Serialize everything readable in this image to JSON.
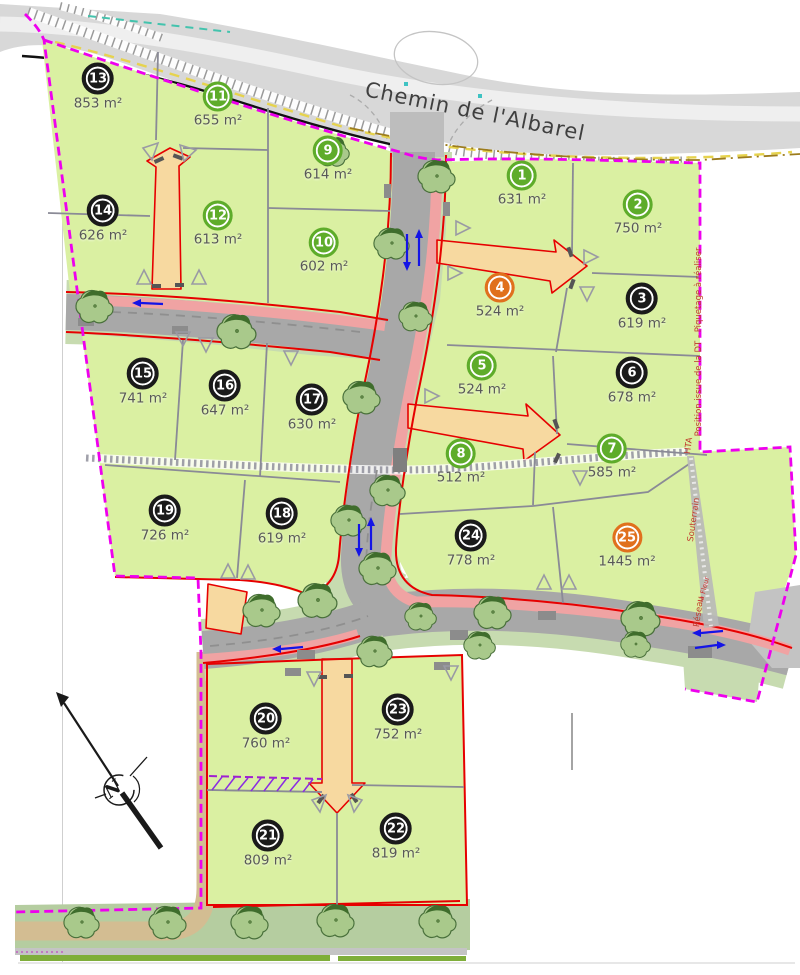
{
  "map": {
    "street_label": "Chemin de l'Albarel",
    "north_letter": "N",
    "area_unit": "m²"
  },
  "annotations": {
    "dt_note": "Position issue de la DT - Piquetage à réaliser",
    "utility_word_1": "Réseau",
    "utility_word_2": "Souterrain",
    "utility_word_3": "HTA",
    "small_label": "la Fleur"
  },
  "colors": {
    "boundary_magenta": "#ee00ee",
    "lot_fill_green": "#daf0a2",
    "road_edge_red": "#e60000",
    "driveway_tan": "#f7d9a0",
    "badge_green": "#5eac2a",
    "badge_black": "#1a1a1a",
    "badge_orange": "#e0701d",
    "arrow_blue": "#1414e6",
    "annotation_red": "#c0392b"
  },
  "lots": [
    {
      "number": "1",
      "area": "631 m²",
      "badge": "green",
      "x": 522,
      "y": 185
    },
    {
      "number": "2",
      "area": "750 m²",
      "badge": "green",
      "x": 638,
      "y": 214
    },
    {
      "number": "3",
      "area": "619 m²",
      "badge": "black",
      "x": 642,
      "y": 308
    },
    {
      "number": "4",
      "area": "524 m²",
      "badge": "orange",
      "x": 500,
      "y": 297
    },
    {
      "number": "5",
      "area": "524 m²",
      "badge": "green",
      "x": 482,
      "y": 375
    },
    {
      "number": "6",
      "area": "678 m²",
      "badge": "black",
      "x": 632,
      "y": 382
    },
    {
      "number": "7",
      "area": "585 m²",
      "badge": "green",
      "x": 612,
      "y": 458
    },
    {
      "number": "8",
      "area": "512 m²",
      "badge": "green",
      "x": 461,
      "y": 463
    },
    {
      "number": "9",
      "area": "614 m²",
      "badge": "green",
      "x": 328,
      "y": 160
    },
    {
      "number": "10",
      "area": "602 m²",
      "badge": "green",
      "x": 324,
      "y": 252
    },
    {
      "number": "11",
      "area": "655 m²",
      "badge": "green",
      "x": 218,
      "y": 106
    },
    {
      "number": "12",
      "area": "613 m²",
      "badge": "green",
      "x": 218,
      "y": 225
    },
    {
      "number": "13",
      "area": "853 m²",
      "badge": "black",
      "x": 98,
      "y": 88
    },
    {
      "number": "14",
      "area": "626 m²",
      "badge": "black",
      "x": 103,
      "y": 220
    },
    {
      "number": "15",
      "area": "741 m²",
      "badge": "black",
      "x": 143,
      "y": 383
    },
    {
      "number": "16",
      "area": "647 m²",
      "badge": "black",
      "x": 225,
      "y": 395
    },
    {
      "number": "17",
      "area": "630 m²",
      "badge": "black",
      "x": 312,
      "y": 409
    },
    {
      "number": "18",
      "area": "619 m²",
      "badge": "black",
      "x": 282,
      "y": 523
    },
    {
      "number": "19",
      "area": "726 m²",
      "badge": "black",
      "x": 165,
      "y": 520
    },
    {
      "number": "20",
      "area": "760 m²",
      "badge": "black",
      "x": 266,
      "y": 728
    },
    {
      "number": "21",
      "area": "809 m²",
      "badge": "black",
      "x": 268,
      "y": 845
    },
    {
      "number": "22",
      "area": "819 m²",
      "badge": "black",
      "x": 396,
      "y": 838
    },
    {
      "number": "23",
      "area": "752 m²",
      "badge": "black",
      "x": 398,
      "y": 719
    },
    {
      "number": "24",
      "area": "778 m²",
      "badge": "black",
      "x": 471,
      "y": 545
    },
    {
      "number": "25",
      "area": "1445 m²",
      "badge": "orange",
      "x": 627,
      "y": 547
    }
  ]
}
